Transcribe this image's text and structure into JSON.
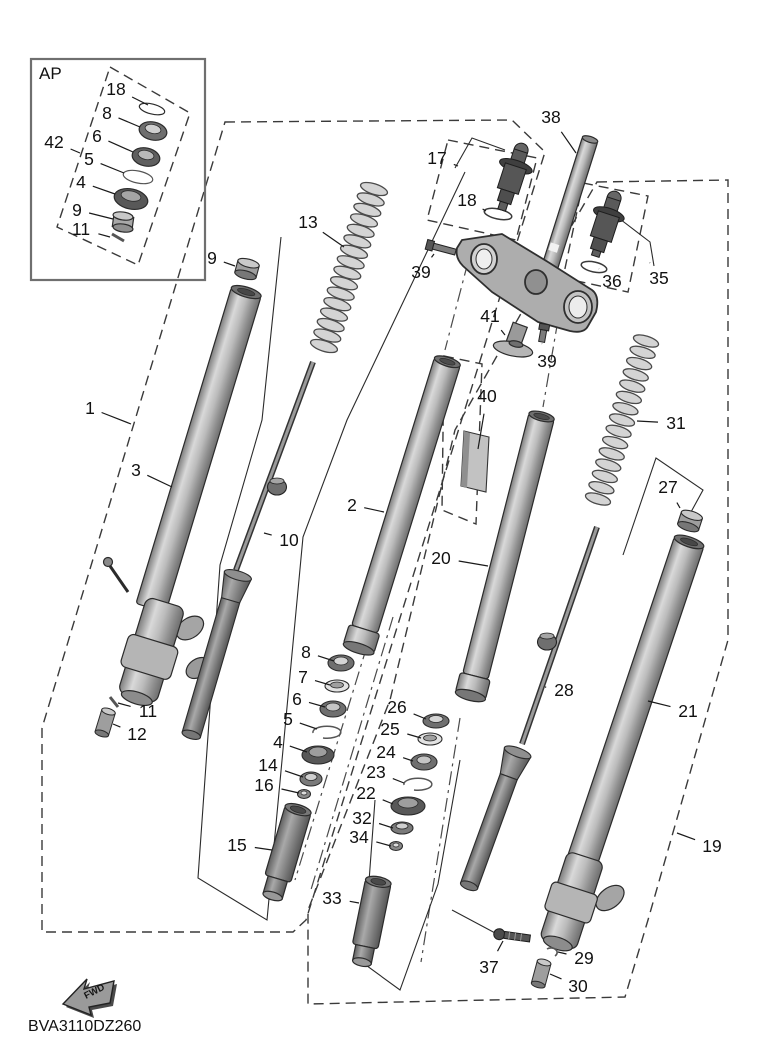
{
  "diagram": {
    "code": "BVA3110DZ260",
    "ap_label": "AP",
    "fwd_label": "FWD",
    "colors": {
      "line": "#2b2b2b",
      "boundary_dash": "#3a3a3a",
      "metal_light": "#d8d8d8",
      "metal_mid": "#ababab",
      "metal_dark": "#5a5a5a",
      "background": "#ffffff"
    },
    "callouts": [
      {
        "id": "g1",
        "label": "1",
        "tx": 90,
        "ty": 408,
        "px": 131,
        "py": 424
      },
      {
        "id": "p3",
        "label": "3",
        "tx": 136,
        "ty": 470,
        "px": 172,
        "py": 487
      },
      {
        "id": "p9",
        "label": "9",
        "tx": 212,
        "ty": 258,
        "px": 235,
        "py": 266
      },
      {
        "id": "p13",
        "label": "13",
        "tx": 308,
        "ty": 222,
        "px": 344,
        "py": 247
      },
      {
        "id": "p10",
        "label": "10",
        "tx": 289,
        "ty": 540,
        "px": 264,
        "py": 533
      },
      {
        "id": "p2",
        "label": "2",
        "tx": 352,
        "ty": 505,
        "px": 384,
        "py": 512
      },
      {
        "id": "p20",
        "label": "20",
        "tx": 441,
        "ty": 558,
        "px": 488,
        "py": 566
      },
      {
        "id": "p40",
        "label": "40",
        "tx": 487,
        "ty": 396,
        "px": 478,
        "py": 449
      },
      {
        "id": "p38",
        "label": "38",
        "tx": 551,
        "ty": 117,
        "px": 576,
        "py": 153
      },
      {
        "id": "p17",
        "label": "17",
        "tx": 437,
        "ty": 158,
        "px": 458,
        "py": 166
      },
      {
        "id": "p18b",
        "label": "18",
        "tx": 467,
        "ty": 200,
        "px": 486,
        "py": 211
      },
      {
        "id": "p39a",
        "label": "39",
        "tx": 421,
        "ty": 272,
        "px": 434,
        "py": 254
      },
      {
        "id": "p39b",
        "label": "39",
        "tx": 547,
        "ty": 361,
        "px": 542,
        "py": 344
      },
      {
        "id": "p41",
        "label": "41",
        "tx": 490,
        "ty": 316,
        "px": 505,
        "py": 335
      },
      {
        "id": "p36",
        "label": "36",
        "tx": 612,
        "ty": 281,
        "px": 599,
        "py": 269
      },
      {
        "id": "p35",
        "label": "35",
        "tx": 659,
        "ty": 278,
        "px": 650,
        "py": 263
      },
      {
        "id": "p31",
        "label": "31",
        "tx": 676,
        "ty": 423,
        "px": 637,
        "py": 421
      },
      {
        "id": "p27",
        "label": "27",
        "tx": 668,
        "ty": 487,
        "px": 680,
        "py": 508
      },
      {
        "id": "p21",
        "label": "21",
        "tx": 688,
        "ty": 711,
        "px": 648,
        "py": 701
      },
      {
        "id": "g19",
        "label": "19",
        "tx": 712,
        "ty": 846,
        "px": 677,
        "py": 833
      },
      {
        "id": "p28",
        "label": "28",
        "tx": 564,
        "ty": 690,
        "px": 545,
        "py": 687
      },
      {
        "id": "p8",
        "label": "8",
        "tx": 306,
        "ty": 652,
        "px": 334,
        "py": 661
      },
      {
        "id": "p7",
        "label": "7",
        "tx": 303,
        "ty": 677,
        "px": 330,
        "py": 685
      },
      {
        "id": "p6",
        "label": "6",
        "tx": 297,
        "ty": 699,
        "px": 325,
        "py": 707
      },
      {
        "id": "p5",
        "label": "5",
        "tx": 288,
        "ty": 719,
        "px": 317,
        "py": 729
      },
      {
        "id": "p4",
        "label": "4",
        "tx": 278,
        "ty": 742,
        "px": 307,
        "py": 752
      },
      {
        "id": "p14",
        "label": "14",
        "tx": 268,
        "ty": 765,
        "px": 303,
        "py": 777
      },
      {
        "id": "p16",
        "label": "16",
        "tx": 264,
        "ty": 785,
        "px": 299,
        "py": 793
      },
      {
        "id": "p15",
        "label": "15",
        "tx": 237,
        "ty": 845,
        "px": 272,
        "py": 850
      },
      {
        "id": "p26",
        "label": "26",
        "tx": 397,
        "ty": 707,
        "px": 426,
        "py": 719
      },
      {
        "id": "p25",
        "label": "25",
        "tx": 390,
        "ty": 729,
        "px": 421,
        "py": 738
      },
      {
        "id": "p24",
        "label": "24",
        "tx": 386,
        "ty": 752,
        "px": 413,
        "py": 761
      },
      {
        "id": "p23",
        "label": "23",
        "tx": 376,
        "ty": 772,
        "px": 404,
        "py": 783
      },
      {
        "id": "p22",
        "label": "22",
        "tx": 366,
        "ty": 793,
        "px": 393,
        "py": 804
      },
      {
        "id": "p32",
        "label": "32",
        "tx": 362,
        "ty": 818,
        "px": 393,
        "py": 828
      },
      {
        "id": "p34",
        "label": "34",
        "tx": 359,
        "ty": 837,
        "px": 391,
        "py": 846
      },
      {
        "id": "p33",
        "label": "33",
        "tx": 332,
        "ty": 898,
        "px": 359,
        "py": 903
      },
      {
        "id": "p37",
        "label": "37",
        "tx": 489,
        "ty": 967,
        "px": 503,
        "py": 941
      },
      {
        "id": "p29",
        "label": "29",
        "tx": 584,
        "ty": 958,
        "px": 558,
        "py": 952
      },
      {
        "id": "p30",
        "label": "30",
        "tx": 578,
        "ty": 986,
        "px": 550,
        "py": 974
      },
      {
        "id": "p11",
        "label": "11",
        "tx": 148,
        "ty": 711,
        "px": 118,
        "py": 703
      },
      {
        "id": "p12",
        "label": "12",
        "tx": 137,
        "ty": 734,
        "px": 113,
        "py": 724
      },
      {
        "id": "ap18",
        "label": "18",
        "tx": 116,
        "ty": 89,
        "px": 148,
        "py": 105
      },
      {
        "id": "ap8",
        "label": "8",
        "tx": 107,
        "ty": 113,
        "px": 140,
        "py": 127
      },
      {
        "id": "ap6",
        "label": "6",
        "tx": 97,
        "ty": 136,
        "px": 133,
        "py": 152
      },
      {
        "id": "ap5",
        "label": "5",
        "tx": 89,
        "ty": 159,
        "px": 124,
        "py": 173
      },
      {
        "id": "ap4",
        "label": "4",
        "tx": 81,
        "ty": 182,
        "px": 115,
        "py": 194
      },
      {
        "id": "ap9",
        "label": "9",
        "tx": 77,
        "ty": 210,
        "px": 113,
        "py": 219
      },
      {
        "id": "ap11",
        "label": "11",
        "tx": 81,
        "ty": 229,
        "px": 110,
        "py": 237
      },
      {
        "id": "ap42",
        "label": "42",
        "tx": 54,
        "ty": 142,
        "px": 80,
        "py": 153
      }
    ],
    "springs": [
      {
        "id": "spring-13",
        "x1": 374,
        "y1": 189,
        "x2": 324,
        "y2": 346,
        "coils": 16,
        "rx": 14,
        "ry": 5.2
      },
      {
        "id": "spring-31",
        "x1": 646,
        "y1": 341,
        "x2": 598,
        "y2": 499,
        "coils": 15,
        "rx": 13,
        "ry": 5
      }
    ]
  }
}
